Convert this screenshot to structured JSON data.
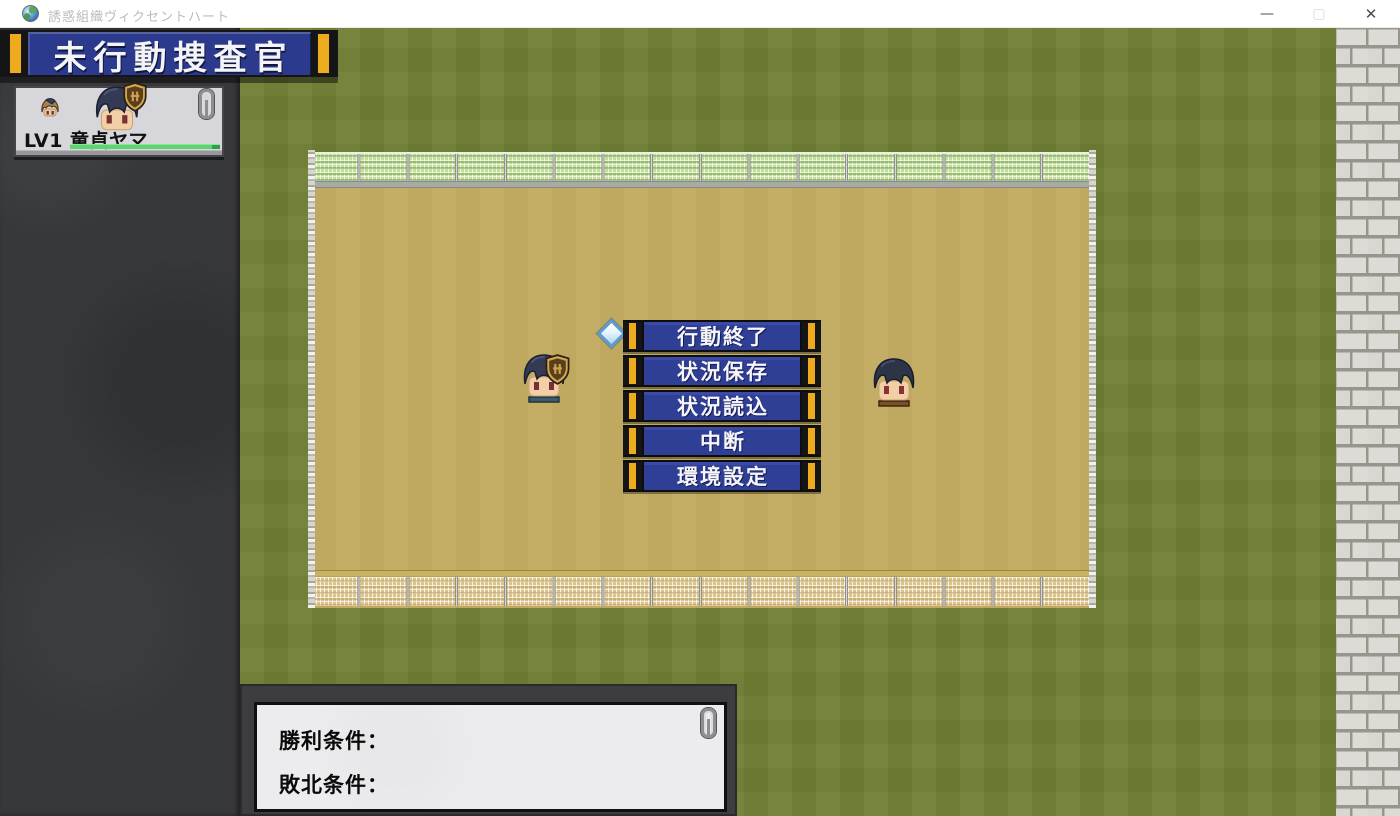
{
  "window": {
    "title": "誘惑組織ヴィクセントハート",
    "minimize_glyph": "—",
    "maximize_glyph": "▢",
    "close_glyph": "✕"
  },
  "banner": {
    "label": "未行動捜査官"
  },
  "unit_panel": {
    "unit_label": "LV1 童貞ヤマ",
    "hp_percent": 100
  },
  "action_menu": {
    "items": [
      {
        "label": "行動終了"
      },
      {
        "label": "状況保存"
      },
      {
        "label": "状況読込"
      },
      {
        "label": "中断"
      },
      {
        "label": "環境設定"
      }
    ]
  },
  "conditions_panel": {
    "victory_label": "勝利条件：",
    "defeat_label": "敗北条件："
  },
  "icons": {
    "app_icon": "globe",
    "pin_icon": "paperclip",
    "cursor_icon": "diamond",
    "badge_icon": "shield-emblem"
  },
  "colors": {
    "grass": "#708034",
    "field_sand": "#c3ac62",
    "menu_blue": "#303f96",
    "banner_blue": "#2c3a8e",
    "accent_gold": "#eeab1e",
    "hp_green": "#5ed46e",
    "sidebar_dark": "#37383a",
    "brick_light": "#dcdbd5"
  }
}
